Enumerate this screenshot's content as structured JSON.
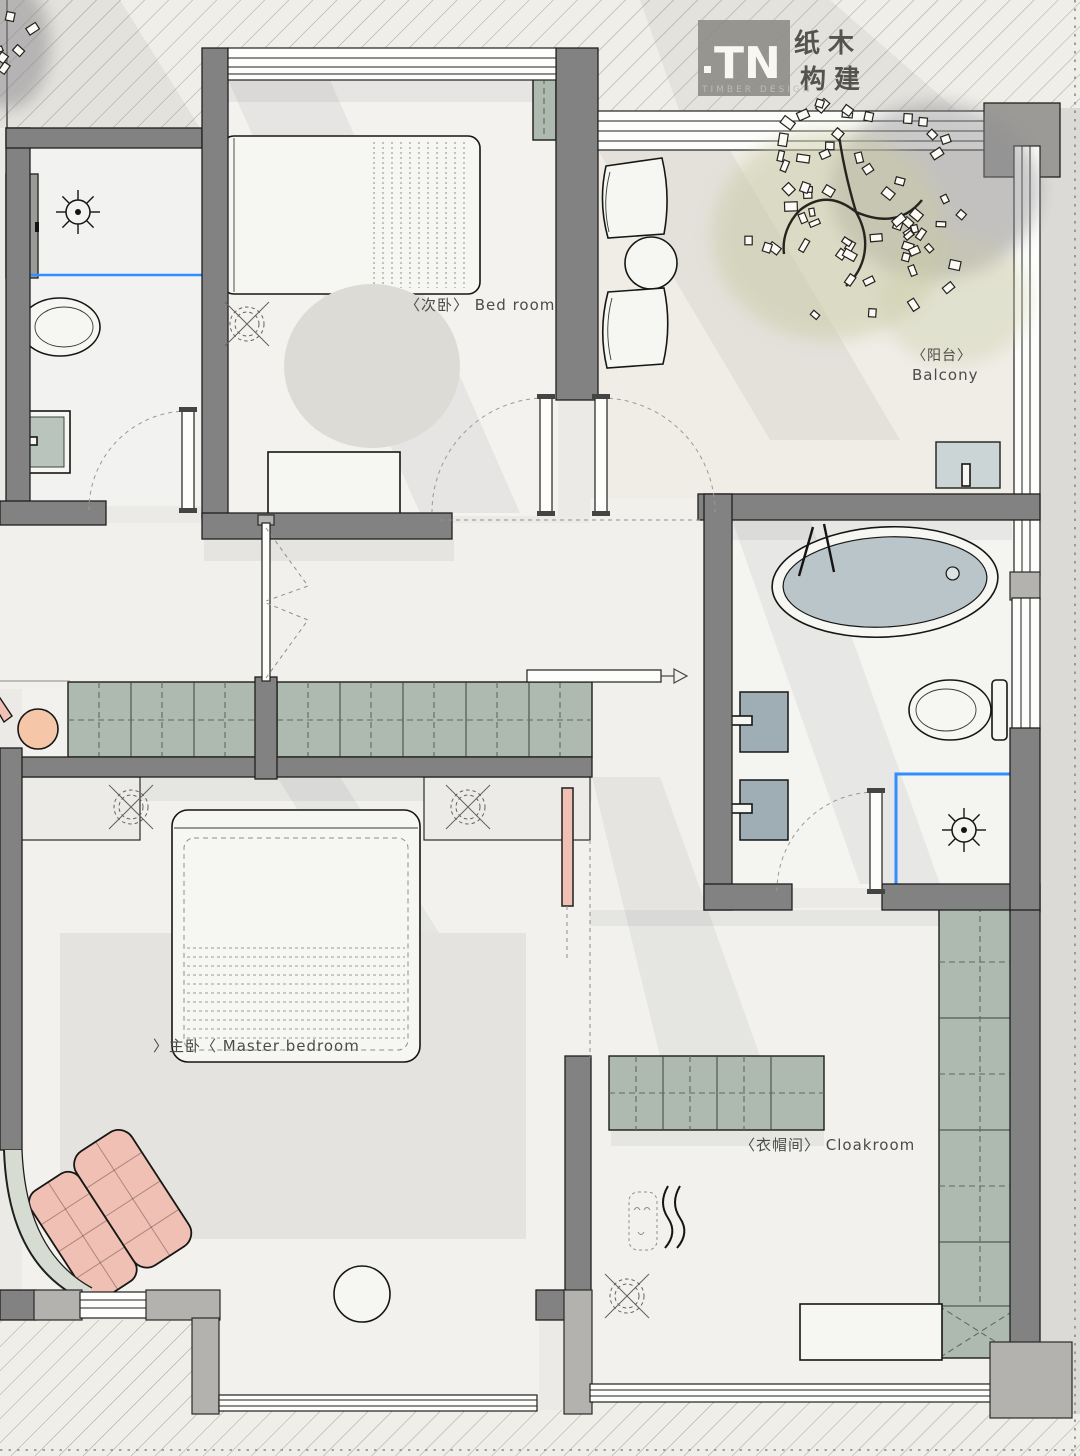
{
  "title": "apartment floor plan",
  "logo": {
    "mark": "TN",
    "brand_cjk_1": "纸木",
    "brand_cjk_2": "构建",
    "brand_sub": "TIMBER DESIGN"
  },
  "rooms": {
    "bedroom": {
      "label": "〈次卧〉 Bed room"
    },
    "balcony": {
      "label_cjk": "〈阳台〉",
      "label_en": "Balcony"
    },
    "master": {
      "label": "〉主卧〈 Master bedroom"
    },
    "cloakroom": {
      "label": "〈衣帽间〉 Cloakroom"
    }
  },
  "colors": {
    "paper": "#eceae6",
    "wall": "#828282",
    "wall_light": "#b3b2ae",
    "cabinet_green": "#aebab0",
    "tub_blue": "#b9c5c9",
    "accent_blue": "#2f8fff",
    "accent_pink": "#f0c0b4",
    "peach": "#f6c6a9"
  }
}
